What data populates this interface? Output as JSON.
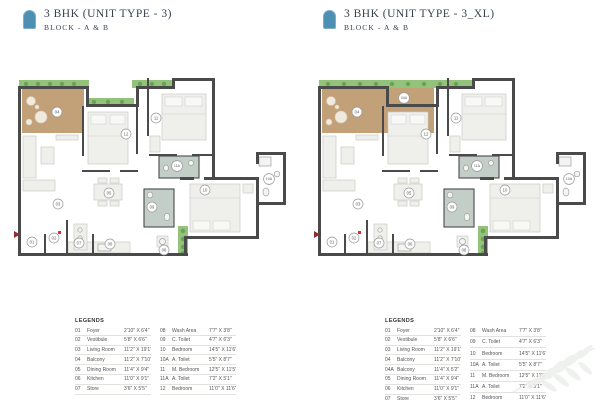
{
  "icons": {
    "header_icon": "arch-door",
    "watermark": "palm-frond",
    "entry_marker": "entry-arrow",
    "door_marker": "red-door-dot"
  },
  "colors": {
    "accent_blue": "#4e8fb4",
    "title_text": "#39424e",
    "wall": "#4a4a4a",
    "deck_tan": "#c2a078",
    "planter_green": "#93c27b",
    "toilet_floor": "#c3cec9",
    "door_marker_red": "#b03a2e"
  },
  "plans": [
    {
      "title": "3 BHK (UNIT TYPE - 3)",
      "subtitle": "BLOCK - A & B",
      "variant": "standard",
      "room_labels": {
        "r01": "01",
        "r02": "02",
        "r03": "03",
        "r04": "04",
        "r05": "05",
        "r06": "06",
        "r07": "07",
        "r08": "08",
        "r09": "09",
        "r10": "10",
        "r10A": "10A",
        "r11": "11",
        "r11A": "11A",
        "r12": "12"
      },
      "legends": {
        "title": "LEGENDS",
        "col1": [
          [
            "01",
            "Foyer",
            "2'10\" X 6'4\""
          ],
          [
            "02",
            "Vestibule",
            "5'8\" X 6'6\""
          ],
          [
            "03",
            "Living Room",
            "11'2\" X 19'1\""
          ],
          [
            "04",
            "Balcony",
            "11'2\" X 7'10\""
          ],
          [
            "05",
            "Dining Room",
            "11'4\" X 9'4\""
          ],
          [
            "06",
            "Kitchen",
            "11'0\" X 9'1\""
          ],
          [
            "07",
            "Store",
            "3'6\" X 5'5\""
          ]
        ],
        "col2": [
          [
            "08",
            "Wash Area",
            "7'7\" X 3'8\""
          ],
          [
            "09",
            "C. Toilet",
            "4'7\" X 6'3\""
          ],
          [
            "10",
            "Bedroom",
            "14'5\" X 11'6\""
          ],
          [
            "10A",
            "A. Toilet",
            "5'5\" X 8'7\""
          ],
          [
            "11",
            "M. Bedroom",
            "12'5\" X 11'5\""
          ],
          [
            "11A",
            "A. Toilet",
            "7'2\" X 5'1\""
          ],
          [
            "12",
            "Bedroom",
            "11'0\" X 11'6\""
          ]
        ]
      }
    },
    {
      "title": "3 BHK (UNIT TYPE - 3_XL)",
      "subtitle": "BLOCK - A & B",
      "variant": "xl",
      "room_labels": {
        "r01": "01",
        "r02": "02",
        "r03": "03",
        "r04": "04",
        "r04A": "04A",
        "r05": "05",
        "r06": "06",
        "r07": "07",
        "r08": "08",
        "r09": "09",
        "r10": "10",
        "r10A": "10A",
        "r11": "11",
        "r11A": "11A",
        "r12": "12"
      },
      "legends": {
        "title": "LEGENDS",
        "col1": [
          [
            "01",
            "Foyer",
            "2'10\" X 6'4\""
          ],
          [
            "02",
            "Vestibule",
            "5'8\" X 6'6\""
          ],
          [
            "03",
            "Living Room",
            "11'2\" X 19'1\""
          ],
          [
            "04",
            "Balcony",
            "11'2\" X 7'10\""
          ],
          [
            "04A",
            "Balcony",
            "11'4\" X 5'2\""
          ],
          [
            "05",
            "Dining Room",
            "11'4\" X 9'4\""
          ],
          [
            "06",
            "Kitchen",
            "11'0\" X 9'1\""
          ],
          [
            "07",
            "Store",
            "3'6\" X 5'5\""
          ]
        ],
        "col2": [
          [
            "08",
            "Wash Area",
            "7'7\" X 3'8\""
          ],
          [
            "09",
            "C. Toilet",
            "4'7\" X 6'3\""
          ],
          [
            "10",
            "Bedroom",
            "14'5\" X 11'6\""
          ],
          [
            "10A",
            "A. Toilet",
            "5'5\" X 8'7\""
          ],
          [
            "11",
            "M. Bedroom",
            "12'5\" X 11'5\""
          ],
          [
            "11A",
            "A. Toilet",
            "7'2\" X 5'1\""
          ],
          [
            "12",
            "Bedroom",
            "11'0\" X 11'6\""
          ]
        ]
      }
    }
  ]
}
